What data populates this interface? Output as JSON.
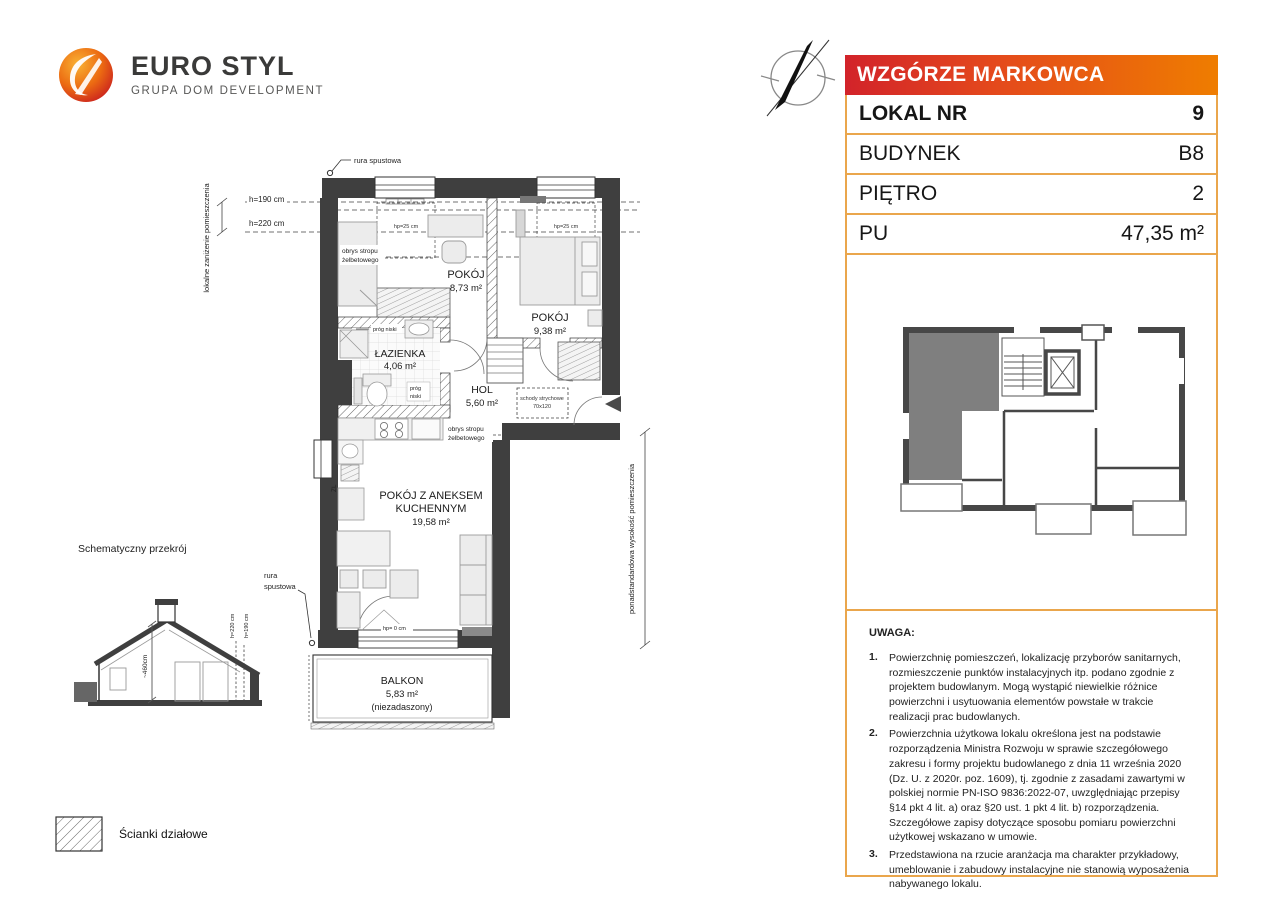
{
  "logo": {
    "title": "EURO STYL",
    "subtitle": "GRUPA DOM DEVELOPMENT"
  },
  "panel": {
    "header": "WZGÓRZE MARKOWCA",
    "accent_red": "#d2232a",
    "accent_orange": "#ef7d00",
    "border_color": "#eaa64c",
    "rows": [
      {
        "label": "LOKAL NR",
        "value": "9"
      },
      {
        "label": "BUDYNEK",
        "value": "B8"
      },
      {
        "label": "PIĘTRO",
        "value": "2"
      },
      {
        "label": "PU",
        "value": "47,35 m²"
      }
    ]
  },
  "notes": {
    "title": "UWAGA:",
    "items": [
      {
        "n": "1.",
        "text": "Powierzchnię pomieszczeń, lokalizację przyborów sanitarnych, rozmieszczenie punktów instalacyjnych itp. podano zgodnie z projektem budowlanym. Mogą wystąpić niewielkie różnice powierzchni i usytuowania elementów powstałe w trakcie realizacji prac budowlanych."
      },
      {
        "n": "2.",
        "text": "Powierzchnia użytkowa lokalu określona jest na podstawie rozporządzenia Ministra Rozwoju w sprawie szczegółowego zakresu i formy projektu budowlanego z dnia 11 września 2020 (Dz. U. z 2020r. poz. 1609), tj. zgodnie z zasadami zawartymi w polskiej normie PN-ISO 9836:2022-07, uwzględniając przepisy §14 pkt 4 lit. a) oraz §20 ust. 1 pkt 4 lit. b) rozporządzenia. Szczegółowe zapisy dotyczące sposobu pomiaru powierzchni użytkowej wskazano w umowie."
      },
      {
        "n": "3.",
        "text": "Przedstawiona na rzucie aranżacja ma charakter przykładowy, umeblowanie i zabudowy instalacyjne nie stanowią wyposażenia nabywanego lokalu."
      }
    ]
  },
  "plan": {
    "rooms": {
      "room1_name": "POKÓJ",
      "room1_area": "8,73 m²",
      "room2_name": "POKÓJ",
      "room2_area": "9,38 m²",
      "bath_name": "ŁAZIENKA",
      "bath_area": "4,06 m²",
      "hol_name": "HOL",
      "hol_area": "5,60 m²",
      "living_l1": "POKÓJ Z ANEKSEM",
      "living_l2": "KUCHENNYM",
      "living_area": "19,58 m²",
      "balcony_name": "BALKON",
      "balcony_area": "5,83 m²",
      "balcony_note": "(niezadaszony)"
    },
    "labels": {
      "rura_spustowa": "rura spustowa",
      "rura_l1": "rura",
      "rura_l2": "spustowa",
      "obrys_l1": "obrys stropu",
      "obrys_l2": "żelbetowego",
      "prog_niski": "próg niski",
      "prog_l1": "próg",
      "prog_l2": "niski",
      "schody_l1": "schody strychowe",
      "schody_l2": "70x120",
      "hp25": "hp=25 cm",
      "hp0": "hp= 0 cm",
      "h190": "h=190 cm",
      "h220": "h=220 cm",
      "lokalne": "lokalne zaniżenie pomieszczenia",
      "ponad": "ponadstandardowa wysokość pomieszczenia",
      "zl": "ZL"
    }
  },
  "section": {
    "title": "Schematyczny przekrój",
    "dim": "~460cm",
    "h220": "h=220 cm",
    "h190": "h=190 cm"
  },
  "legend": {
    "label": "Ścianki działowe"
  }
}
